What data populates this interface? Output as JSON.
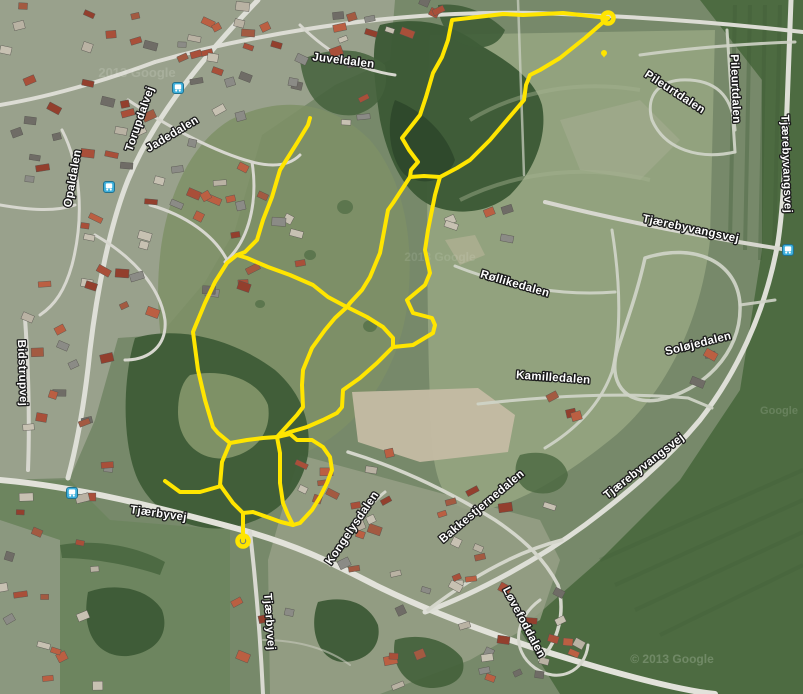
{
  "map": {
    "road_labels": [
      {
        "text": "Juveldalen",
        "x": 343,
        "y": 64,
        "rotate": 7
      },
      {
        "text": "Torupdalvej",
        "x": 143,
        "y": 120,
        "rotate": -71
      },
      {
        "text": "Jadedalen",
        "x": 174,
        "y": 137,
        "rotate": -31
      },
      {
        "text": "Opaldalen",
        "x": 76,
        "y": 179,
        "rotate": -80
      },
      {
        "text": "Bidstrupvej",
        "x": 19,
        "y": 373,
        "rotate": 88
      },
      {
        "text": "Tjærbyvej",
        "x": 158,
        "y": 517,
        "rotate": 8
      },
      {
        "text": "Tjærbyvej",
        "x": 266,
        "y": 622,
        "rotate": 86
      },
      {
        "text": "Kongelysdalen",
        "x": 355,
        "y": 530,
        "rotate": -56
      },
      {
        "text": "Bakkestjernedalen",
        "x": 484,
        "y": 509,
        "rotate": -40
      },
      {
        "text": "Løvefoddalen",
        "x": 521,
        "y": 624,
        "rotate": 62
      },
      {
        "text": "Røllikedalen",
        "x": 514,
        "y": 287,
        "rotate": 16
      },
      {
        "text": "Kamilledalen",
        "x": 553,
        "y": 381,
        "rotate": 4
      },
      {
        "text": "Soløjedalen",
        "x": 699,
        "y": 347,
        "rotate": -14
      },
      {
        "text": "Tjærebyvangsvej",
        "x": 690,
        "y": 232,
        "rotate": 12
      },
      {
        "text": "Tjærebyvangsvej",
        "x": 783,
        "y": 164,
        "rotate": 88
      },
      {
        "text": "Tjærebyvangsvej",
        "x": 646,
        "y": 469,
        "rotate": -38
      },
      {
        "text": "Pileurtdalen",
        "x": 673,
        "y": 95,
        "rotate": 33
      },
      {
        "text": "Pileurtdalen",
        "x": 732,
        "y": 89,
        "rotate": 88
      }
    ],
    "attribution_watermarks": [
      {
        "text": "2013 Google",
        "x": 137,
        "y": 77,
        "size": 13,
        "opacity": 0.18
      },
      {
        "text": "2013 Google",
        "x": 440,
        "y": 261,
        "size": 12,
        "opacity": 0.12
      },
      {
        "text": "© 2013 Google",
        "x": 672,
        "y": 663,
        "size": 12,
        "opacity": 0.22
      },
      {
        "text": "Google",
        "x": 779,
        "y": 414,
        "size": 11,
        "opacity": 0.16
      }
    ],
    "bus_stops": [
      {
        "x": 178,
        "y": 88
      },
      {
        "x": 109,
        "y": 187
      },
      {
        "x": 788,
        "y": 250
      },
      {
        "x": 72,
        "y": 493
      }
    ],
    "route": {
      "color": "#ffe500",
      "segments": [
        [
          [
            608,
            18
          ],
          [
            563,
            13
          ],
          [
            523,
            15
          ],
          [
            503,
            14
          ],
          [
            452,
            20
          ],
          [
            448,
            40
          ],
          [
            442,
            57
          ],
          [
            433,
            73
          ],
          [
            426,
            97
          ],
          [
            420,
            115
          ],
          [
            402,
            138
          ],
          [
            409,
            150
          ],
          [
            418,
            162
          ],
          [
            411,
            170
          ],
          [
            410,
            177
          ]
        ],
        [
          [
            410,
            177
          ],
          [
            424,
            176
          ],
          [
            440,
            177
          ]
        ],
        [
          [
            440,
            177
          ],
          [
            457,
            168
          ],
          [
            470,
            160
          ],
          [
            490,
            140
          ],
          [
            524,
            100
          ],
          [
            526,
            85
          ],
          [
            530,
            75
          ],
          [
            540,
            70
          ],
          [
            560,
            58
          ],
          [
            585,
            38
          ],
          [
            608,
            18
          ]
        ],
        [
          [
            440,
            177
          ],
          [
            435,
            195
          ],
          [
            430,
            220
          ],
          [
            428,
            230
          ],
          [
            425,
            250
          ],
          [
            430,
            273
          ],
          [
            425,
            285
          ],
          [
            407,
            300
          ],
          [
            413,
            313
          ],
          [
            432,
            318
          ],
          [
            435,
            325
          ],
          [
            433,
            333
          ],
          [
            413,
            345
          ],
          [
            393,
            347
          ],
          [
            377,
            363
          ],
          [
            360,
            378
          ],
          [
            343,
            390
          ],
          [
            342,
            407
          ],
          [
            337,
            413
          ],
          [
            323,
            420
          ],
          [
            307,
            427
          ],
          [
            290,
            432
          ],
          [
            277,
            437
          ]
        ],
        [
          [
            410,
            177
          ],
          [
            393,
            203
          ],
          [
            388,
            210
          ],
          [
            380,
            253
          ],
          [
            370,
            277
          ],
          [
            362,
            290
          ],
          [
            350,
            303
          ],
          [
            347,
            307
          ]
        ],
        [
          [
            347,
            307
          ],
          [
            367,
            317
          ],
          [
            383,
            327
          ],
          [
            393,
            338
          ],
          [
            393,
            347
          ]
        ],
        [
          [
            347,
            307
          ],
          [
            335,
            318
          ],
          [
            325,
            330
          ],
          [
            312,
            348
          ],
          [
            303,
            370
          ],
          [
            302,
            385
          ],
          [
            303,
            407
          ],
          [
            297,
            415
          ],
          [
            277,
            437
          ]
        ],
        [
          [
            310,
            118
          ],
          [
            308,
            125
          ],
          [
            297,
            143
          ],
          [
            280,
            170
          ],
          [
            272,
            197
          ],
          [
            263,
            220
          ],
          [
            257,
            240
          ],
          [
            245,
            252
          ],
          [
            237,
            255
          ]
        ],
        [
          [
            237,
            255
          ],
          [
            247,
            258
          ],
          [
            268,
            267
          ],
          [
            290,
            275
          ],
          [
            313,
            285
          ],
          [
            328,
            297
          ],
          [
            343,
            305
          ],
          [
            347,
            307
          ]
        ],
        [
          [
            237,
            255
          ],
          [
            227,
            263
          ],
          [
            215,
            282
          ],
          [
            205,
            303
          ],
          [
            195,
            327
          ],
          [
            193,
            332
          ],
          [
            198,
            370
          ],
          [
            205,
            400
          ],
          [
            213,
            427
          ],
          [
            218,
            433
          ],
          [
            230,
            443
          ]
        ],
        [
          [
            277,
            437
          ],
          [
            263,
            438
          ],
          [
            247,
            440
          ],
          [
            230,
            443
          ]
        ],
        [
          [
            230,
            443
          ],
          [
            222,
            462
          ],
          [
            220,
            485
          ],
          [
            233,
            503
          ],
          [
            242,
            512
          ],
          [
            243,
            513
          ]
        ],
        [
          [
            221,
            486
          ],
          [
            200,
            492
          ],
          [
            180,
            492
          ],
          [
            165,
            481
          ]
        ],
        [
          [
            243,
            513
          ],
          [
            243,
            541
          ]
        ],
        [
          [
            243,
            513
          ],
          [
            253,
            512
          ],
          [
            270,
            518
          ],
          [
            281,
            522
          ],
          [
            293,
            525
          ]
        ],
        [
          [
            277,
            437
          ],
          [
            280,
            453
          ],
          [
            280,
            470
          ],
          [
            280,
            483
          ],
          [
            283,
            503
          ],
          [
            288,
            515
          ],
          [
            293,
            525
          ]
        ],
        [
          [
            277,
            437
          ],
          [
            290,
            434
          ],
          [
            297,
            440
          ],
          [
            312,
            440
          ],
          [
            323,
            447
          ],
          [
            330,
            457
          ],
          [
            332,
            470
          ],
          [
            327,
            483
          ],
          [
            320,
            497
          ],
          [
            312,
            510
          ],
          [
            300,
            523
          ],
          [
            293,
            525
          ]
        ]
      ],
      "endpoint_markers": [
        {
          "x": 608,
          "y": 18
        },
        {
          "x": 243,
          "y": 541
        }
      ],
      "waypoint_dot": {
        "x": 604,
        "y": 53
      }
    }
  }
}
